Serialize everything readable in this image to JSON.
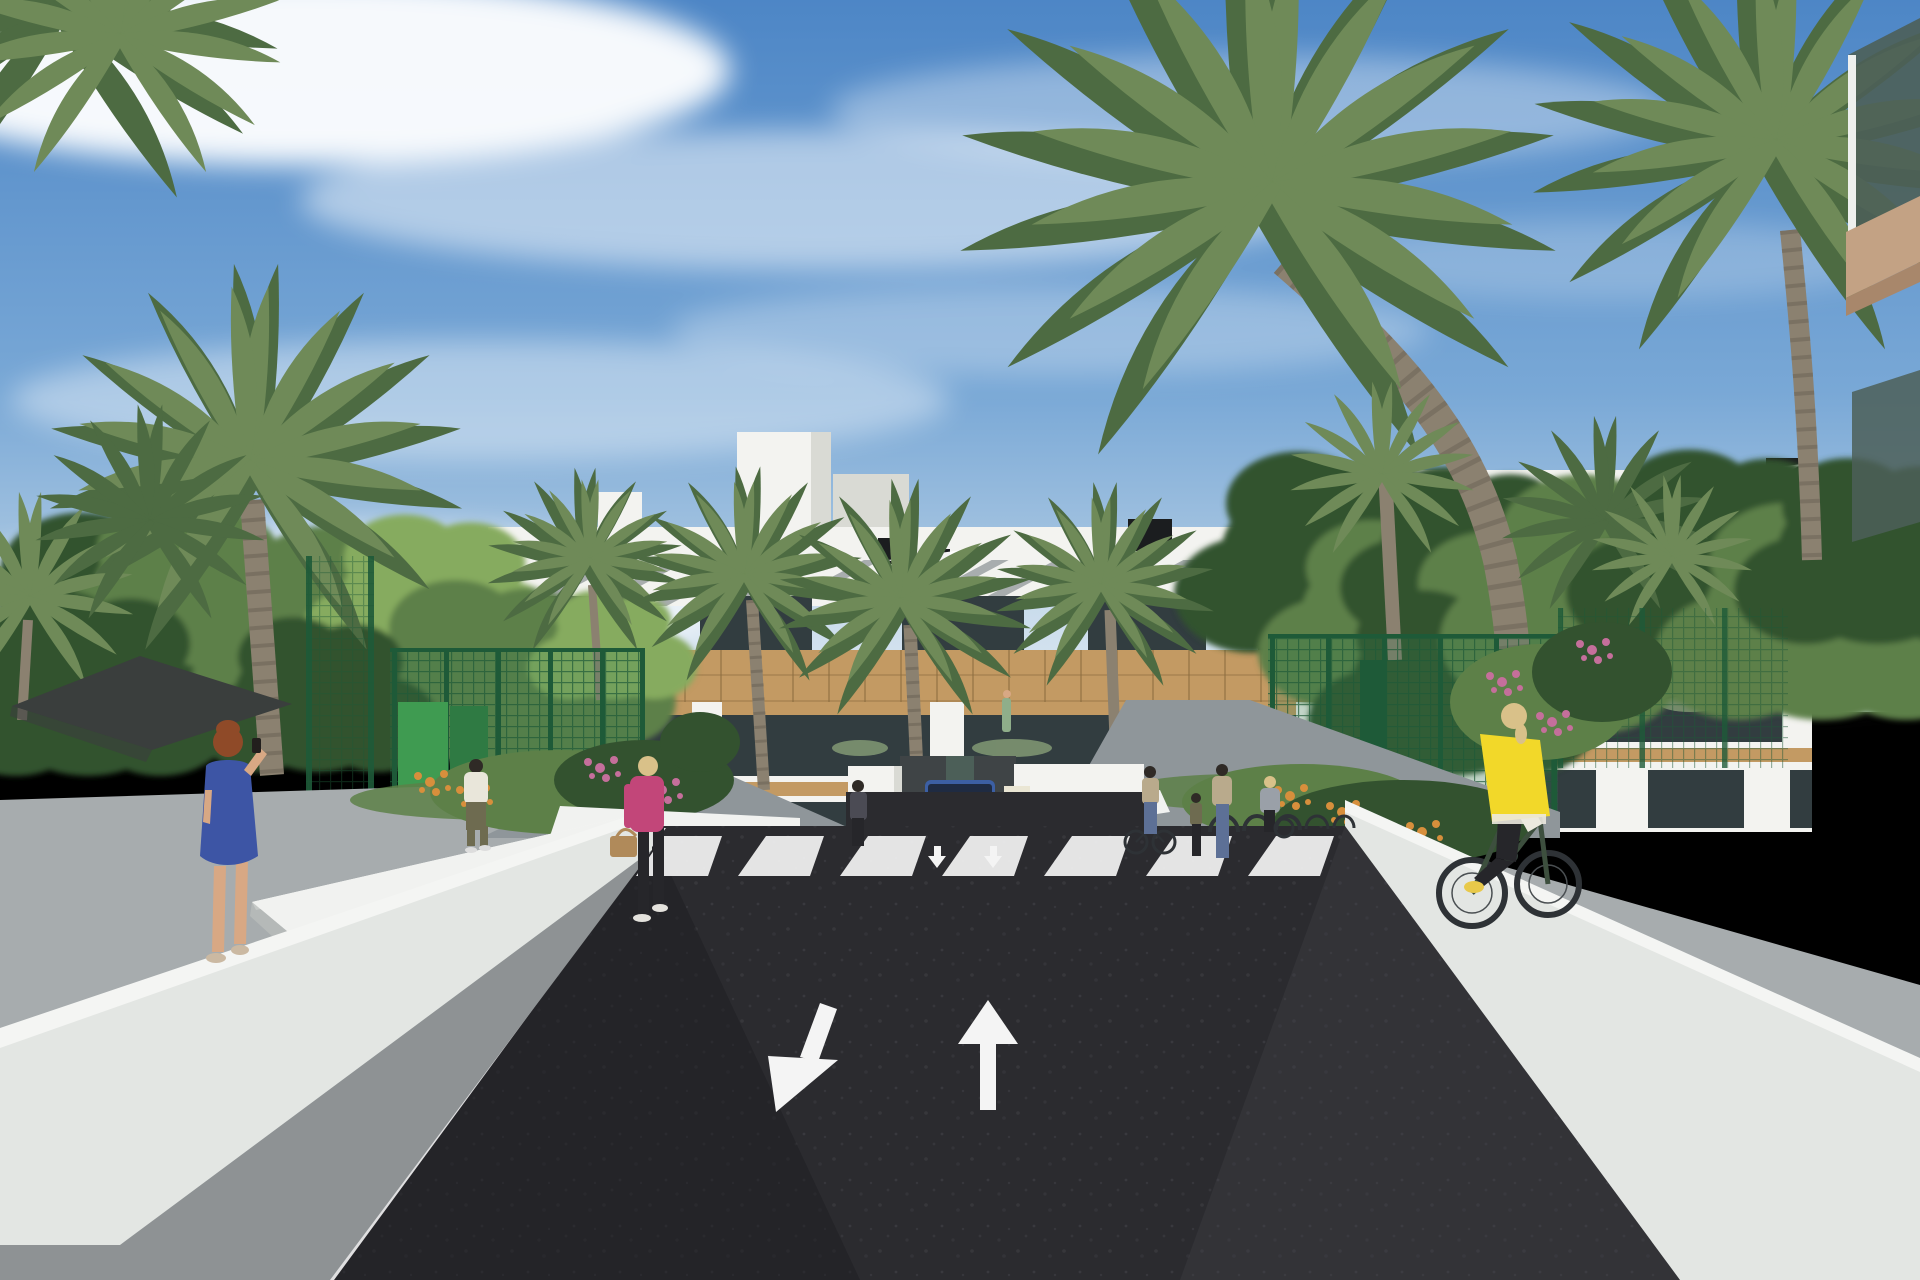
{
  "meta": {
    "kind": "architectural-rendering",
    "width_px": 1920,
    "height_px": 1280
  },
  "scene": {
    "setting": "Sunny 3D rendering of a modern white three-story apartment complex with wood-clad balconies, palm trees and gardens, viewed down a new dark asphalt access road leading to an underground garage",
    "sky": {
      "description": "blue sky with wispy diagonal cirrus clouds, brighter toward horizon"
    },
    "road": {
      "surface": "fresh dark asphalt",
      "markings": [
        "pedestrian crosswalk stripes",
        "down-left lane arrow",
        "up lane arrow",
        "white edge line",
        "small garage threshold arrows"
      ],
      "crosswalk_stripe_count": 7
    },
    "vehicles": [
      {
        "name": "blue-suv",
        "description": "blue SUV emerging from garage ramp between white walls"
      }
    ],
    "people": [
      {
        "name": "woman-blue-dress",
        "description": "red-haired woman in a blue patterned dress talking on phone, left sidewalk"
      },
      {
        "name": "man-white-shirt",
        "description": "man in white tee and olive trousers on the entrance path"
      },
      {
        "name": "woman-pink-jacket",
        "description": "blonde woman in pink jacket with tan handbag crossing left plaza"
      },
      {
        "name": "woman-dark-top",
        "description": "woman standing by the garage wall"
      },
      {
        "name": "woman-with-bicycle",
        "description": "woman in tan top wheeling a bicycle near the racks"
      },
      {
        "name": "child",
        "description": "child standing with adults near bike racks"
      },
      {
        "name": "woman-patterned-top",
        "description": "woman in patterned top and jeans with the child"
      },
      {
        "name": "woman-gray-jacket",
        "description": "woman in gray jacket at the bike racks"
      },
      {
        "name": "cyclist-yellow-vest",
        "description": "blonde cyclist in yellow vest and black leggings riding along right wall"
      },
      {
        "name": "resident-on-balcony",
        "description": "small figure on a first-floor balcony"
      }
    ],
    "architecture": [
      "three-story white apartment block with slatted shade fascia",
      "timber-clad balcony band and pergolas",
      "rooftop terraces with parasols and service units",
      "green mesh security fencing",
      "white perimeter and planter walls",
      "underground garage ramp",
      "bike racks",
      "foreground building corner with green glass balcony",
      "ochre neighbour building glimpsed through trees",
      "dark shade sail on the left"
    ],
    "vegetation": [
      "tall date palms",
      "fan palms",
      "leafy green trees",
      "pink flowering shrubs",
      "orange flower beds",
      "lawn verges"
    ]
  },
  "colors": {
    "sky_top": "#4d86c6",
    "sky_mid": "#79a8d6",
    "sky_horizon": "#cfdfeb",
    "cloud": "#ffffff",
    "building_white": "#f3f3f0",
    "building_shade": "#d9dad4",
    "slat_shadow": "#5d686c",
    "wood": "#c39a63",
    "wood_dark": "#8a6a3e",
    "glass_dark": "#323d40",
    "glass_green": "#4c5f58",
    "ground_white_wall": "#f1f2f0",
    "wall_face": "#e3e6e3",
    "wall_shadow": "#b9bdba",
    "sidewalk": "#a7acae",
    "sidewalk_dark": "#8e9294",
    "path_gray": "#8f969a",
    "road": "#2b2b2f",
    "road_shadow": "#1d1d21",
    "marking_white": "#f4f4f4",
    "fence_green": "#2f7d4e",
    "fence_dark": "#1e5a38",
    "panel_green": "#3f9b51",
    "panel_green_dark": "#2f7a43",
    "foliage_dark": "#33522f",
    "foliage_mid": "#5d8048",
    "foliage_light": "#86ab5f",
    "palm_green": "#6f8a58",
    "palm_green_dark": "#4d6b42",
    "palm_trunk": "#8b8170",
    "palm_trunk_dark": "#6e6557",
    "sail": "#3a3e3d",
    "car_blue": "#3c5fa3",
    "car_glass": "#1f2b42",
    "grille": "#9ba3ad",
    "ochre": "#c9a24e",
    "skin": "#d8a884",
    "hair_red": "#8f4a28",
    "hair_blonde": "#d9c189",
    "hair_dark": "#2f2a26",
    "dress_blue": "#3d55a5",
    "jacket_pink": "#c24679",
    "bag_tan": "#b08a5a",
    "tee_white": "#e9e6da",
    "pants_olive": "#6e6b50",
    "pants_black": "#26262a",
    "vest_yellow": "#f2d829",
    "sleeve_white": "#ece9df",
    "shoe_yellow": "#e8c94a",
    "bike_green": "#3d4f3e",
    "tire": "#2e3236",
    "flower_pink": "#c56f9b",
    "flower_orange": "#d78f3c",
    "furniture_green": "#7d9471",
    "roof_unit": "#1b1d1f",
    "jeans": "#5d7096",
    "top_charcoal": "#4b4b54",
    "top_floral": "#b9aa8c",
    "gray_jacket": "#9aa0a8",
    "slab_tan": "#c3a284",
    "slab_under": "#a8876b",
    "sign_cream": "#eae6d4",
    "resident_green": "#8fae8a"
  }
}
